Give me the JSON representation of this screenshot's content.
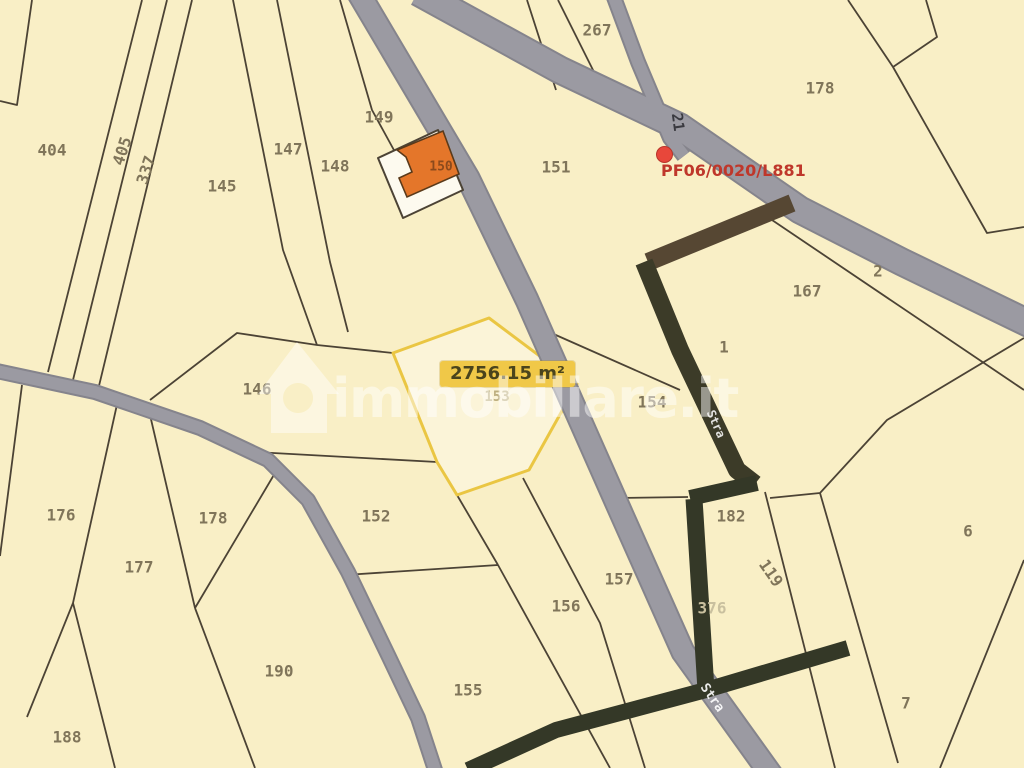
{
  "map": {
    "watermark": "immobiliare.it",
    "marker": {
      "label": "PF06/0020/L881"
    },
    "highlight": {
      "area_label": "2756.15 m²",
      "parcel_number": "153"
    },
    "building": {
      "number": "150"
    },
    "parcels": [
      {
        "n": "404",
        "x": 52,
        "y": 150
      },
      {
        "n": "405",
        "x": 122,
        "y": 151,
        "rot": -72
      },
      {
        "n": "337",
        "x": 146,
        "y": 170,
        "rot": -72
      },
      {
        "n": "145",
        "x": 222,
        "y": 186
      },
      {
        "n": "147",
        "x": 288,
        "y": 149
      },
      {
        "n": "148",
        "x": 335,
        "y": 166
      },
      {
        "n": "149",
        "x": 379,
        "y": 117
      },
      {
        "n": "150",
        "x": 441,
        "y": 167,
        "color": "#8b4a1c",
        "size": 13
      },
      {
        "n": "267",
        "x": 597,
        "y": 30
      },
      {
        "n": "178",
        "x": 820,
        "y": 88
      },
      {
        "n": "151",
        "x": 556,
        "y": 167
      },
      {
        "n": "2",
        "x": 878,
        "y": 271
      },
      {
        "n": "167",
        "x": 807,
        "y": 291
      },
      {
        "n": "1",
        "x": 724,
        "y": 347
      },
      {
        "n": "146",
        "x": 257,
        "y": 389
      },
      {
        "n": "153",
        "x": 497,
        "y": 397,
        "color": "#bcae7e",
        "size": 14
      },
      {
        "n": "154",
        "x": 652,
        "y": 402
      },
      {
        "n": "176",
        "x": 61,
        "y": 515
      },
      {
        "n": "178",
        "x": 213,
        "y": 518
      },
      {
        "n": "177",
        "x": 139,
        "y": 567
      },
      {
        "n": "152",
        "x": 376,
        "y": 516
      },
      {
        "n": "182",
        "x": 731,
        "y": 516
      },
      {
        "n": "119",
        "x": 771,
        "y": 573,
        "rot": 55
      },
      {
        "n": "376",
        "x": 712,
        "y": 608,
        "color": "#c9c09f"
      },
      {
        "n": "157",
        "x": 619,
        "y": 579
      },
      {
        "n": "156",
        "x": 566,
        "y": 606
      },
      {
        "n": "155",
        "x": 468,
        "y": 690
      },
      {
        "n": "190",
        "x": 279,
        "y": 671
      },
      {
        "n": "188",
        "x": 67,
        "y": 737
      },
      {
        "n": "6",
        "x": 968,
        "y": 531
      },
      {
        "n": "7",
        "x": 906,
        "y": 703
      }
    ],
    "road_labels": [
      {
        "text": "21",
        "x": 678,
        "y": 122,
        "rot": 82,
        "color": "#3a3a40",
        "size": 15
      },
      {
        "text": "Stra",
        "x": 716,
        "y": 424,
        "rot": 66,
        "color": "rgba(255,255,255,0.85)",
        "size": 12
      },
      {
        "text": "Stra",
        "x": 712,
        "y": 698,
        "rot": 55,
        "color": "rgba(255,255,255,0.9)",
        "size": 13
      }
    ],
    "colors": {
      "background": "#f9efc6",
      "road_gray": "#9b9aa2",
      "road_edge": "#85848c",
      "dark_road": "#343827",
      "dark_road_upper": "#564733",
      "parcel_line": "#4c4335",
      "parcel_label": "#80755a",
      "highlight_border": "#eac643",
      "highlight_fill": "#fbf4d8",
      "area_label_bg": "#f0c848",
      "marker_red": "#e8473b",
      "marker_text": "#bf372b",
      "building_orange": "#e4762a",
      "watermark_white": "rgba(255,255,255,0.48)"
    }
  }
}
